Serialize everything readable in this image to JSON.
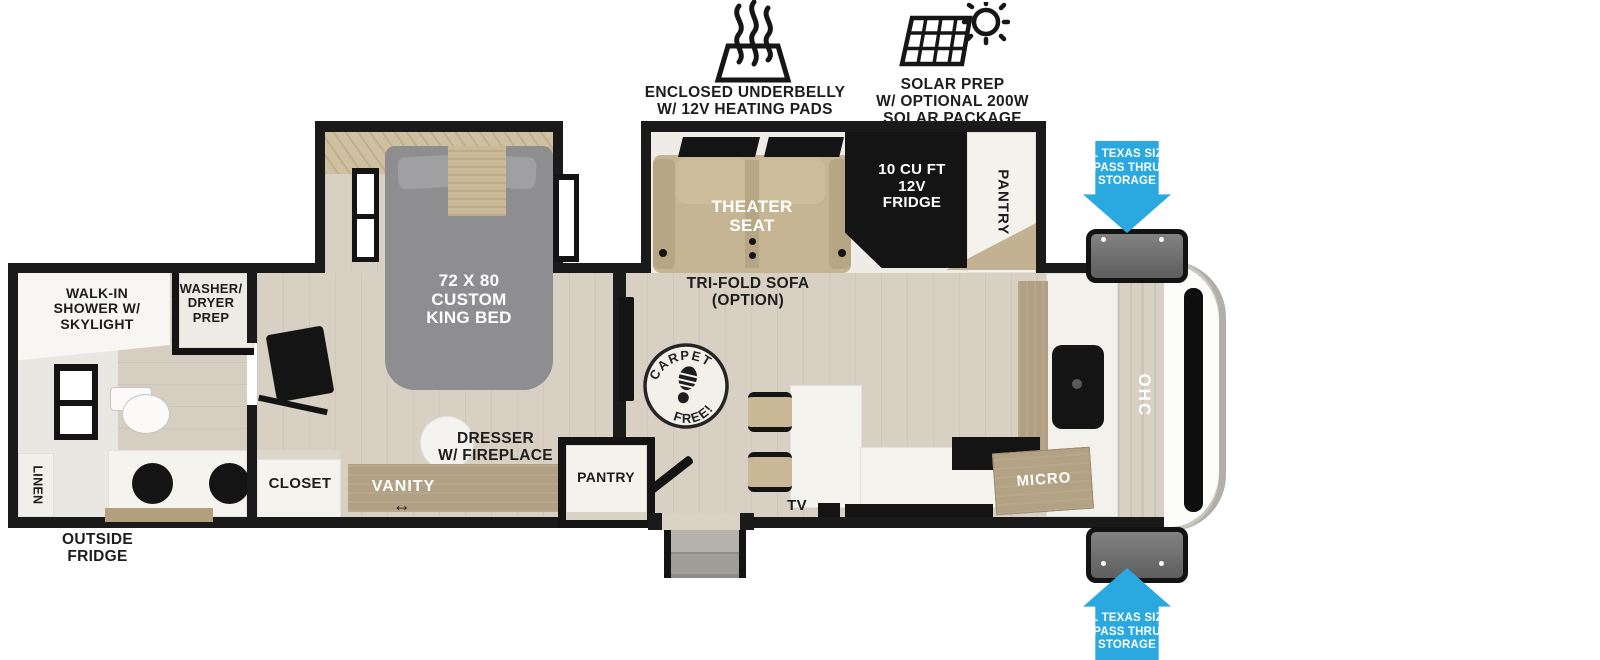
{
  "annotations": {
    "underbelly": "ENCLOSED UNDERBELLY\nW/ 12V HEATING PADS",
    "solar": "SOLAR PREP\nW/ OPTIONAL 200W\nSOLAR PACKAGE"
  },
  "storage_arrows": {
    "label": "XL TEXAS SIZE\nPASS THRU\nSTORAGE"
  },
  "bathroom": {
    "shower_label": "WALK-IN\nSHOWER W/\nSKYLIGHT",
    "washer_dryer_label": "WASHER/\nDRYER\nPREP",
    "linen_label": "LINEN",
    "outside_fridge_label": "OUTSIDE\nFRIDGE"
  },
  "bedroom": {
    "bed_label": "72 X 80\nCUSTOM\nKING BED",
    "closet_label": "CLOSET",
    "vanity_label": "VANITY",
    "dresser_label": "DRESSER\nW/ FIREPLACE",
    "pantry_label": "PANTRY",
    "door_arrow": "↔"
  },
  "living": {
    "theater_label": "THEATER\nSEAT",
    "trifold_label": "TRI-FOLD SOFA\n(OPTION)",
    "fridge_label": "10 CU FT\n12V\nFRIDGE",
    "slide_pantry_label": "PANTRY",
    "tv_label": "TV",
    "carpet_top": "CARPET",
    "carpet_bottom": "FREE!"
  },
  "kitchen": {
    "micro_label": "MICRO",
    "ohc_label": "OHC"
  },
  "colors": {
    "accent_blue": "#29a9e0",
    "wall_black": "#1a1a1a",
    "floor_wood": "#d8d1c3",
    "cabinet_wood": "#b1a083",
    "bed_gray": "#8e8e91",
    "sofa_tan": "#c6b592",
    "storage_gray": "#777777"
  }
}
